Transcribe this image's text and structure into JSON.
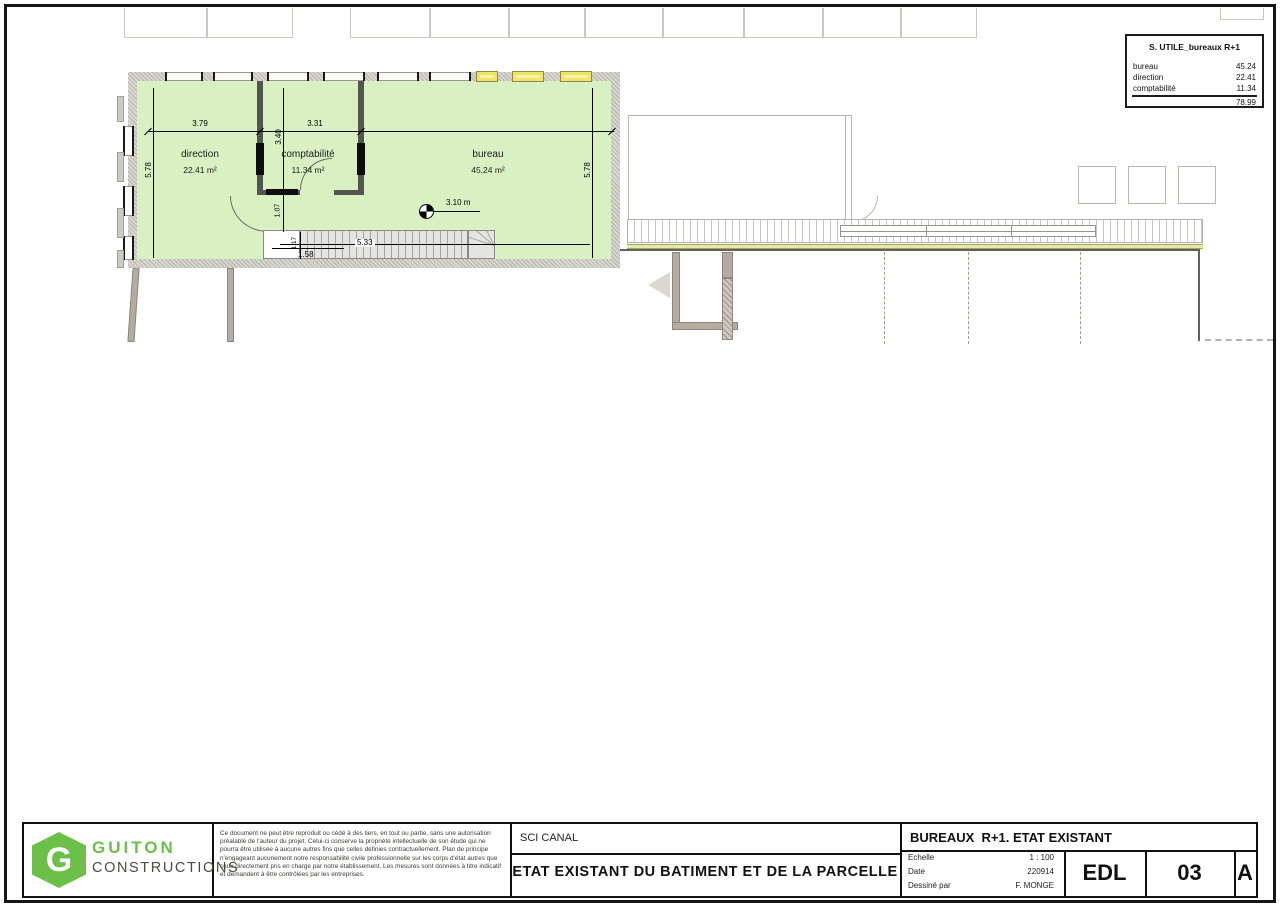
{
  "colors": {
    "accent-green": "#6cc04a",
    "room-green": "#d9f0c2",
    "window-yellow": "#f0e467",
    "strip-yellow": "#e6e9a8"
  },
  "summary_table": {
    "title": "S. UTILE_bureaux R+1",
    "rows": [
      {
        "label": "bureau",
        "value": "45.24"
      },
      {
        "label": "direction",
        "value": "22.41"
      },
      {
        "label": "comptabilité",
        "value": "11.34"
      }
    ],
    "total": "78.99"
  },
  "plan": {
    "rooms": [
      {
        "name": "direction",
        "area": "22.41 m²"
      },
      {
        "name": "comptabilité",
        "area": "11.34 m²"
      },
      {
        "name": "bureau",
        "area": "45.24 m²"
      }
    ],
    "dims": {
      "direction_width": "3.79",
      "compta_width": "3.31",
      "compta_height": "3.40",
      "left_height": "5.78",
      "right_height": "5.78",
      "hall_depth": "1.07",
      "landing_width": "1.17",
      "stair_entry": "1.58",
      "stair_run": "5.33",
      "ceiling_height": "3.10 m"
    }
  },
  "title_block": {
    "company": {
      "logo_letter": "G",
      "line1": "GUITON",
      "line2": "CONSTRUCTIONS"
    },
    "disclaimer": "Ce document ne peut être reproduit ou cédé à des tiers, en tout ou partie, sans une autorisation préalable de l'auteur du projet. Celui-ci conserve la propriété intellectuelle de son étude qui ne pourra être utilisée à aucune autres fins que celles définies contractuellement. Plan de principe n'engageant aucunement notre responsabilité civile professionnelle sur les corps d'état autres que ceux directement pris en charge par notre établissement. Les mesures sont données à titre indicatif et demandent à être contrôlées par les entreprises.",
    "client": "SCI CANAL",
    "project_title": "ETAT EXISTANT DU BATIMENT ET DE LA PARCELLE",
    "sheet_title": "BUREAUX  R+1. ETAT EXISTANT",
    "meta": [
      {
        "label": "Echelle",
        "value": "1 : 100"
      },
      {
        "label": "Date",
        "value": "220914"
      },
      {
        "label": "Dessiné par",
        "value": "F. MONGE"
      }
    ],
    "doc_code": "EDL",
    "sheet_number": "03",
    "revision": "A"
  }
}
